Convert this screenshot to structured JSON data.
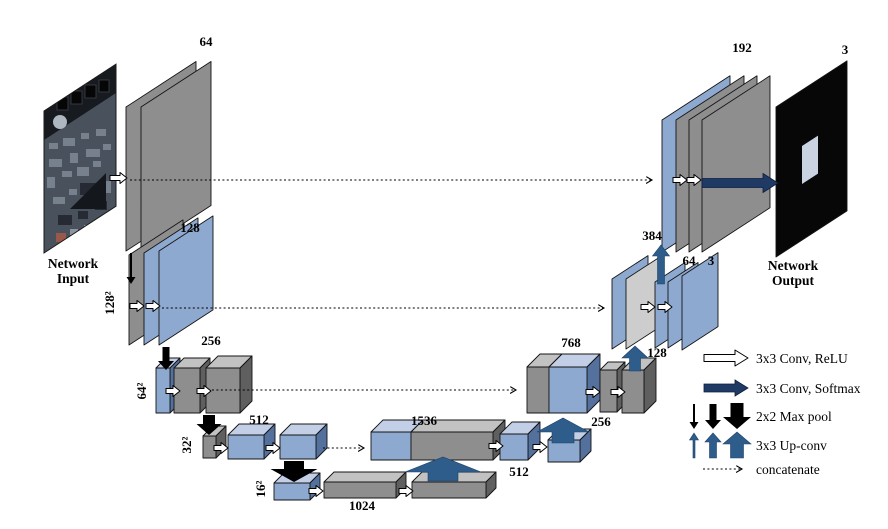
{
  "figure": {
    "input_caption": [
      "Network",
      "Input"
    ],
    "output_caption": [
      "Network",
      "Output"
    ]
  },
  "channel_labels": {
    "enc64": "64",
    "enc128": "128",
    "enc256": "256",
    "enc512": "512",
    "bottleneck": "1024",
    "dec1536": "1536",
    "dec512": "512",
    "up256": "256",
    "dec768": "768",
    "up128": "128",
    "dec384": "384",
    "dec64": "64",
    "dec3": "3",
    "top192": "192",
    "out3": "3"
  },
  "resolution_labels": {
    "r128": "128²",
    "r64": "64²",
    "r32": "32²",
    "r16": "16²"
  },
  "legend": {
    "conv_relu": "3x3 Conv, ReLU",
    "conv_softmax": "3x3 Conv, Softmax",
    "max_pool": "2x2 Max pool",
    "up_conv": "3x3 Up-conv",
    "concatenate": "concatenate"
  },
  "colors": {
    "feature_gray": "#8e8e8e",
    "feature_blue": "#8ea9cf",
    "concat_lightgray": "#cdcdcd",
    "softmax_navy": "#1f3a64",
    "upconv_blue": "#2e5d8c",
    "maxpool_black": "#000000"
  }
}
